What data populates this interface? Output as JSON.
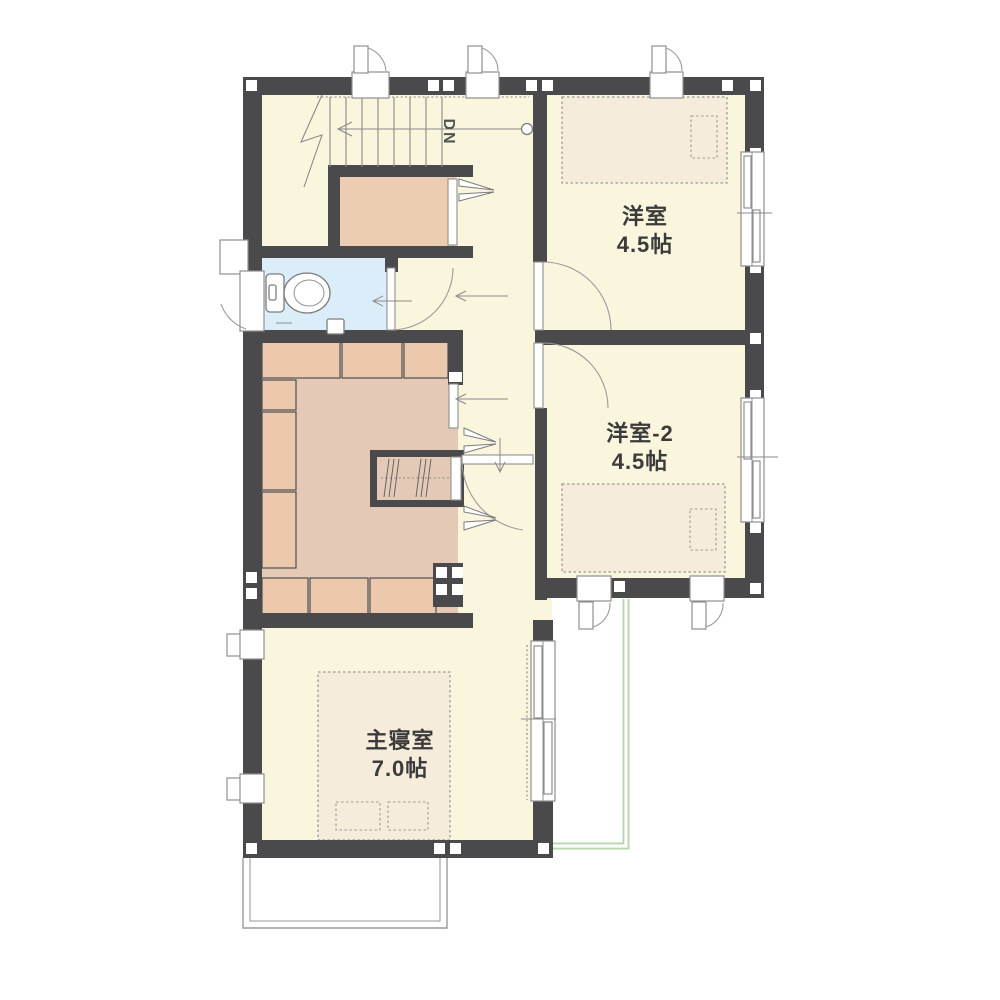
{
  "plan": {
    "type": "floor-plan",
    "rooms": [
      {
        "name": "洋室",
        "area": "4.5帖"
      },
      {
        "name": "洋室-2",
        "area": "4.5帖"
      },
      {
        "name": "主寝室",
        "area": "7.0帖"
      }
    ],
    "stairs_label": "DN",
    "palette": {
      "wall": "#4a4a4c",
      "floor": "#faf5dd",
      "wic_floor": "#e4c9b6",
      "shelf": "#ecc9ac",
      "closet": "#edcdb2",
      "toilet_floor": "#dbedf8",
      "bed": "#f6ecdc",
      "roof_line": "#b9d7ae",
      "line": "#8a8a8a",
      "text": "#3b3b3b"
    }
  }
}
